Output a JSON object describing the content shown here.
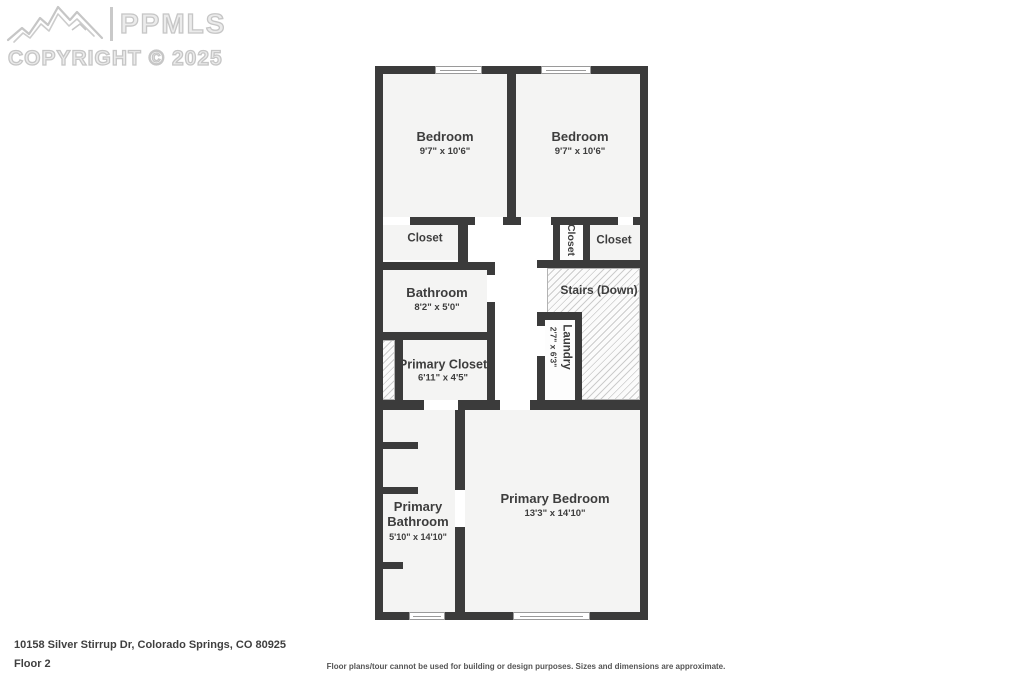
{
  "watermark": {
    "brand": "PPMLS",
    "copyright": "COPYRIGHT © 2025"
  },
  "plan": {
    "rooms": [
      {
        "name": "Bedroom",
        "dims": "9'7\" x 10'6\""
      },
      {
        "name": "Bedroom",
        "dims": "9'7\" x 10'6\""
      },
      {
        "name": "Closet"
      },
      {
        "name": "Closet"
      },
      {
        "name": "Closet"
      },
      {
        "name": "Stairs (Down)"
      },
      {
        "name": "Bathroom",
        "dims": "8'2\" x 5'0\""
      },
      {
        "name": "Primary Closet",
        "dims": "6'11\" x 4'5\""
      },
      {
        "name": "Laundry",
        "dims": "2'7\" x 6'3\""
      },
      {
        "name": "Primary Bathroom",
        "dims": "5'10\" x 14'10\""
      },
      {
        "name": "Primary Bedroom",
        "dims": "13'3\" x 14'10\""
      }
    ]
  },
  "footer": {
    "address": "10158 Silver Stirrup Dr, Colorado Springs, CO 80925",
    "floor_label": "Floor 2",
    "disclaimer": "Floor plans/tour cannot be used for building or design purposes. Sizes and dimensions are approximate."
  },
  "colors": {
    "wall": "#3b3b3b",
    "room_fill": "#f4f4f3",
    "hatch_line": "#cccccc",
    "label_text": "#3d3d3d",
    "watermark": "#c6c6c6"
  }
}
